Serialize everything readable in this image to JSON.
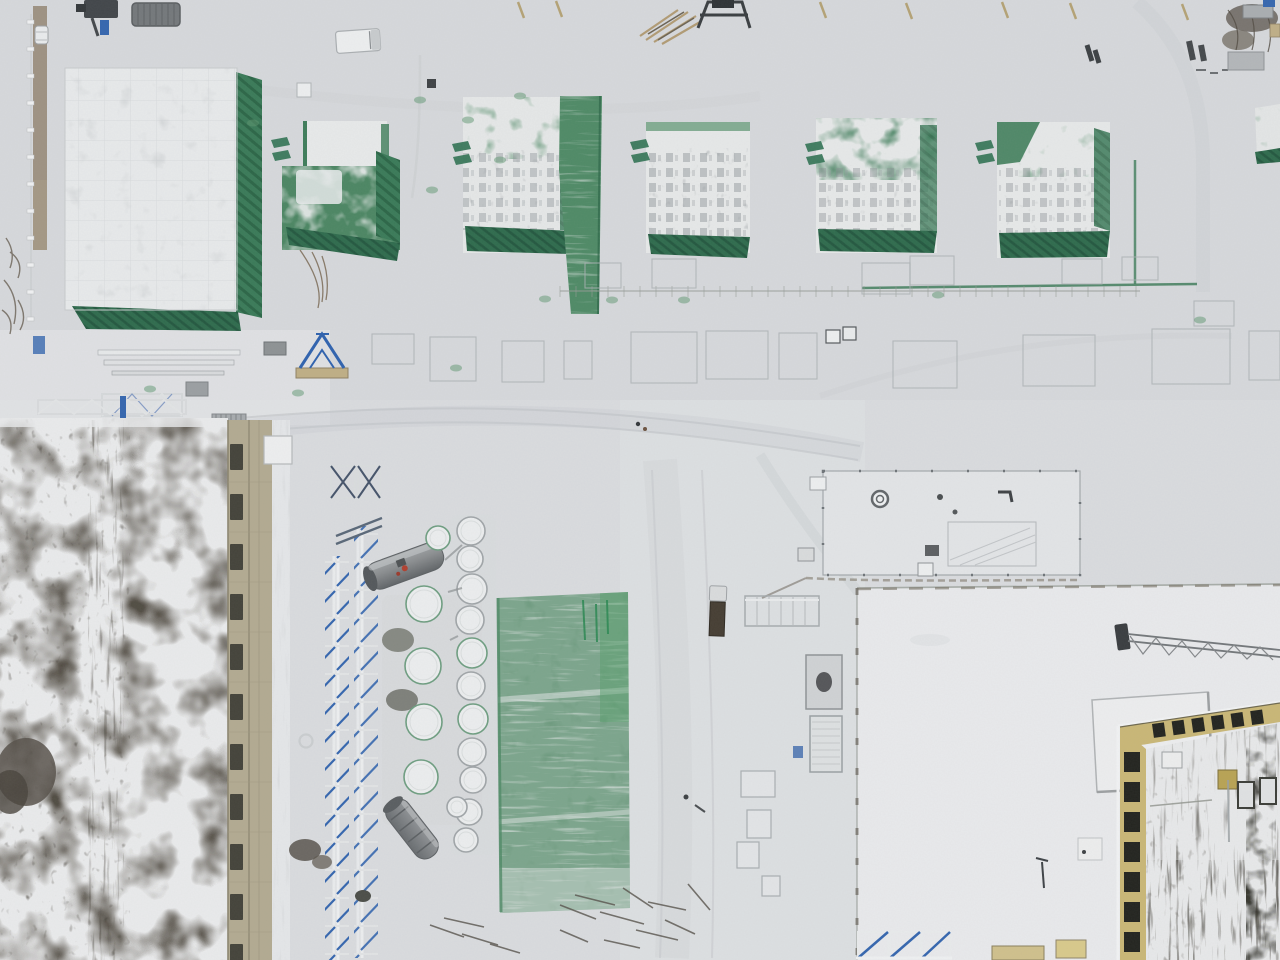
{
  "scene": {
    "type": "aerial-drone-photograph",
    "subject": "Snow-covered construction site: green tarp-wrapped building row, dark mottled roof with tan facade, storage tank farm, green mesh laydown area, white warehouse roofs, yellow-faced building under construction",
    "season": "winter",
    "view_angle": "top-down"
  },
  "palette": {
    "snow": "#d9dbde",
    "snow_bright": "#e9eaec",
    "snow_track": "#c7cacd",
    "tarp_green": "#3a7a58",
    "tarp_green_dark": "#2c6647",
    "tarp_green_light": "#5d9570",
    "mesh_green": "#7ca58c",
    "roof_dark": "#453f35",
    "facade_tan": "#b2aa91",
    "facade_yellow": "#c9b776",
    "yellow_window": "#23241f",
    "window_dark_left": "#3b3b33",
    "facade_line": "#a29a82",
    "steel_blue": "#3566ae",
    "tank_gray": "#8a8d8f",
    "tank_white": "#ebedee",
    "tank_rim": "#a0a5a8",
    "tank_rim_green": "#6f9e81",
    "chalk": "#aab0b3",
    "rust_red": "#b0402f",
    "post_white": "#f0f1f2"
  },
  "top_row": {
    "building_count": 7,
    "vent_tabs": [
      [
        271,
        140
      ],
      [
        272,
        153
      ],
      [
        452,
        144
      ],
      [
        453,
        157
      ],
      [
        630,
        142
      ],
      [
        631,
        155
      ],
      [
        805,
        144
      ],
      [
        806,
        157
      ],
      [
        975,
        143
      ],
      [
        976,
        156
      ]
    ]
  },
  "tank_farm": {
    "tanks": [
      [
        471,
        531,
        14
      ],
      [
        470,
        559,
        13
      ],
      [
        472,
        589,
        15
      ],
      [
        470,
        620,
        14
      ],
      [
        472,
        653,
        15
      ],
      [
        471,
        686,
        14
      ],
      [
        473,
        719,
        15
      ],
      [
        472,
        752,
        14
      ],
      [
        473,
        780,
        13
      ],
      [
        469,
        812,
        13
      ],
      [
        466,
        840,
        12
      ],
      [
        424,
        604,
        18
      ],
      [
        423,
        666,
        18
      ],
      [
        424,
        722,
        18
      ],
      [
        421,
        777,
        17
      ],
      [
        438,
        538,
        12
      ],
      [
        457,
        807,
        10
      ]
    ],
    "green_rim_indices": [
      4,
      6,
      11,
      12,
      13,
      14,
      15
    ],
    "cylinder_top": {
      "cx": 405,
      "cy": 566,
      "length": 80,
      "diameter": 28,
      "angle_deg": -20
    },
    "cylinder_bottom": {
      "cx": 412,
      "cy": 829,
      "length": 68,
      "diameter": 25,
      "angle_deg": 52
    }
  },
  "layout_marks": {
    "chalk_rects": [
      [
        372,
        334,
        42,
        30
      ],
      [
        430,
        337,
        46,
        44
      ],
      [
        502,
        341,
        42,
        41
      ],
      [
        564,
        341,
        28,
        38
      ],
      [
        631,
        332,
        66,
        51
      ],
      [
        706,
        331,
        62,
        48
      ],
      [
        779,
        333,
        38,
        46
      ],
      [
        893,
        341,
        64,
        47
      ],
      [
        1023,
        335,
        72,
        51
      ],
      [
        1152,
        329,
        78,
        55
      ],
      [
        1249,
        331,
        31,
        49
      ],
      [
        585,
        263,
        36,
        25
      ],
      [
        652,
        259,
        44,
        29
      ],
      [
        862,
        263,
        48,
        31
      ],
      [
        910,
        256,
        44,
        29
      ],
      [
        1062,
        259,
        40,
        25
      ],
      [
        1122,
        257,
        36,
        23
      ],
      [
        1194,
        301,
        40,
        25
      ]
    ],
    "scaffold_line": {
      "x1": 560,
      "x2": 1140,
      "y": 291,
      "tick_step": 16
    }
  },
  "left_building": {
    "windows": {
      "x": 230,
      "w": 13,
      "h": 26,
      "y_start": 444,
      "y_step": 50,
      "count": 11
    }
  },
  "yellow_building": {
    "left_windows": {
      "x": 1124,
      "w": 16,
      "h": 20,
      "y_start": 752,
      "y_step": 30,
      "count": 7
    },
    "top_windows": {
      "x_start": 1152,
      "x_step": 20,
      "count": 6,
      "y_start": 724,
      "y_step": -2.6,
      "w": 12,
      "h": 14
    }
  },
  "perimeter": {
    "fence_posts": {
      "x": 27,
      "y_start": 20,
      "y_step": 27,
      "count": 12
    }
  },
  "ground": {
    "green_smudges": [
      [
        150,
        389
      ],
      [
        298,
        393
      ],
      [
        456,
        368
      ],
      [
        545,
        299
      ],
      [
        612,
        300
      ],
      [
        684,
        300
      ],
      [
        938,
        295
      ],
      [
        1200,
        320
      ],
      [
        253,
        123
      ],
      [
        420,
        100
      ],
      [
        468,
        120
      ],
      [
        520,
        96
      ],
      [
        500,
        160
      ],
      [
        432,
        190
      ]
    ]
  }
}
